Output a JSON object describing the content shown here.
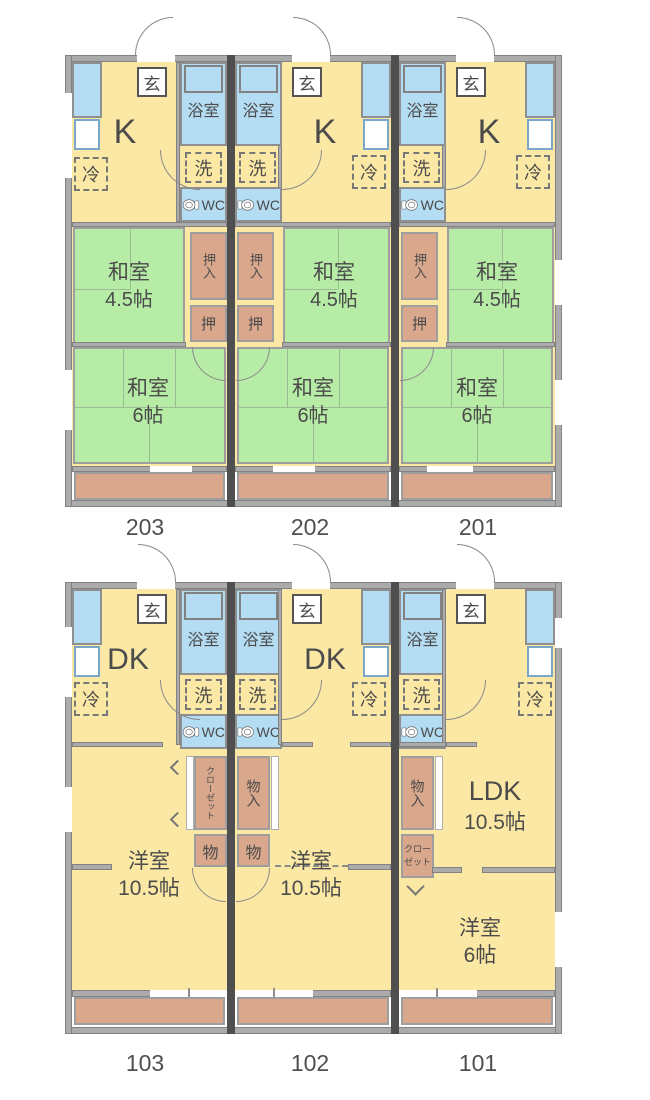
{
  "colors": {
    "room_yellow": "#FBE8A4",
    "tatami_green": "#B6ECA5",
    "water_blue": "#B4DCF2",
    "closet_salmon": "#D8A78C",
    "wall_gray": "#ABABAB",
    "unit_divider": "#4F4F4F",
    "text": "#4B4B4B"
  },
  "floor2": {
    "units": [
      {
        "number": "203",
        "genkan": "玄",
        "kitchen": "K",
        "bath": "浴室",
        "laundry": "洗",
        "wc": "WC",
        "fridge": "冷",
        "oshiire": "押入",
        "oshi": "押",
        "washitsu45": "和室",
        "washitsu45_size": "4.5帖",
        "washitsu6": "和室",
        "washitsu6_size": "6帖"
      },
      {
        "number": "202",
        "genkan": "玄",
        "kitchen": "K",
        "bath": "浴室",
        "laundry": "洗",
        "wc": "WC",
        "fridge": "冷",
        "oshiire": "押入",
        "oshi": "押",
        "washitsu45": "和室",
        "washitsu45_size": "4.5帖",
        "washitsu6": "和室",
        "washitsu6_size": "6帖"
      },
      {
        "number": "201",
        "genkan": "玄",
        "kitchen": "K",
        "bath": "浴室",
        "laundry": "洗",
        "wc": "WC",
        "fridge": "冷",
        "oshiire": "押入",
        "oshi": "押",
        "washitsu45": "和室",
        "washitsu45_size": "4.5帖",
        "washitsu6": "和室",
        "washitsu6_size": "6帖"
      }
    ]
  },
  "floor1": {
    "units": [
      {
        "number": "103",
        "genkan": "玄",
        "dk": "DK",
        "bath": "浴室",
        "laundry": "洗",
        "wc": "WC",
        "fridge": "冷",
        "closet": "クローゼット",
        "mono": "物",
        "yoshitsu": "洋室",
        "yoshitsu_size": "10.5帖"
      },
      {
        "number": "102",
        "genkan": "玄",
        "dk": "DK",
        "bath": "浴室",
        "laundry": "洗",
        "wc": "WC",
        "fridge": "冷",
        "monoire": "物入",
        "mono": "物",
        "yoshitsu": "洋室",
        "yoshitsu_size": "10.5帖"
      },
      {
        "number": "101",
        "genkan": "玄",
        "ldk": "LDK",
        "ldk_size": "10.5帖",
        "bath": "浴室",
        "laundry": "洗",
        "wc": "WC",
        "fridge": "冷",
        "monoire": "物入",
        "closet_l1": "クロー",
        "closet_l2": "ゼット",
        "yoshitsu": "洋室",
        "yoshitsu_size": "6帖"
      }
    ]
  }
}
